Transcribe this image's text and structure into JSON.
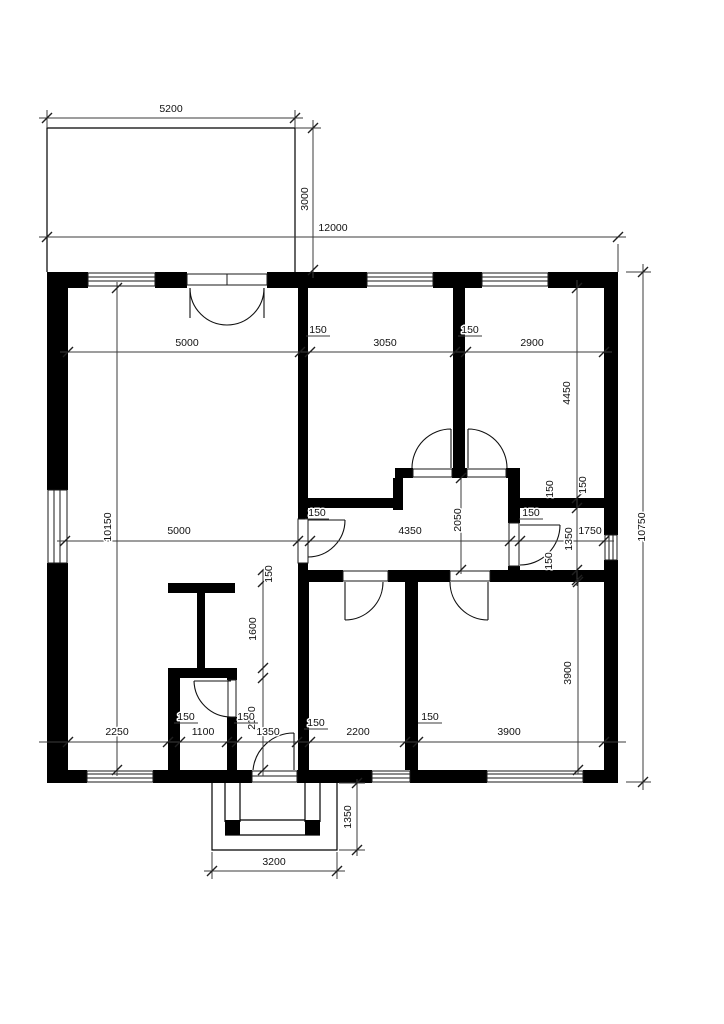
{
  "figure": {
    "kind": "architectural floor plan",
    "units": "mm"
  },
  "colors": {
    "wall": "#000000",
    "line": "#3b3b3b",
    "background": "#ffffff",
    "text": "#111111"
  },
  "dim_labels": [
    {
      "name": "terrace-width",
      "t": "5200",
      "x": 171,
      "y": 112,
      "r": 0,
      "ul": false
    },
    {
      "name": "overall-width",
      "t": "12000",
      "x": 333,
      "y": 231,
      "r": 0,
      "ul": false
    },
    {
      "name": "terrace-depth",
      "t": "3000",
      "x": 308,
      "y": 199,
      "r": -90,
      "ul": false
    },
    {
      "name": "overall-depth",
      "t": "10750",
      "x": 645,
      "y": 527,
      "r": -90,
      "ul": false
    },
    {
      "name": "interior-depth",
      "t": "10150",
      "x": 111,
      "y": 527,
      "r": -90,
      "ul": false
    },
    {
      "name": "living-width-top",
      "t": "5000",
      "x": 187,
      "y": 346,
      "r": 0,
      "ul": false
    },
    {
      "name": "room2-width",
      "t": "3050",
      "x": 385,
      "y": 346,
      "r": 0,
      "ul": false
    },
    {
      "name": "room3-width",
      "t": "2900",
      "x": 532,
      "y": 346,
      "r": 0,
      "ul": false
    },
    {
      "name": "wall-150-top-1",
      "t": "150",
      "x": 318,
      "y": 333,
      "r": 0,
      "ul": true
    },
    {
      "name": "wall-150-top-2",
      "t": "150",
      "x": 470,
      "y": 333,
      "r": 0,
      "ul": true
    },
    {
      "name": "room3-depth",
      "t": "4450",
      "x": 570,
      "y": 393,
      "r": -90,
      "ul": false
    },
    {
      "name": "living-width-mid",
      "t": "5000",
      "x": 179,
      "y": 534,
      "r": 0,
      "ul": false
    },
    {
      "name": "hall-width",
      "t": "4350",
      "x": 410,
      "y": 534,
      "r": 0,
      "ul": false
    },
    {
      "name": "bath-width",
      "t": "1750",
      "x": 590,
      "y": 534,
      "r": 0,
      "ul": false
    },
    {
      "name": "wall-150-hall-door",
      "t": "150",
      "x": 317,
      "y": 516,
      "r": 0,
      "ul": true
    },
    {
      "name": "wall-150-bath-door",
      "t": "150",
      "x": 531,
      "y": 516,
      "r": 0,
      "ul": true
    },
    {
      "name": "wall-150-bath-top-a",
      "t": "150",
      "x": 553,
      "y": 489,
      "r": -90,
      "ul": false
    },
    {
      "name": "wall-150-bath-top-b",
      "t": "150",
      "x": 586,
      "y": 485,
      "r": -90,
      "ul": false
    },
    {
      "name": "bath-depth",
      "t": "1350",
      "x": 572,
      "y": 539,
      "r": -90,
      "ul": false
    },
    {
      "name": "wall-150-bath-bottom",
      "t": "150",
      "x": 552,
      "y": 561,
      "r": -90,
      "ul": false
    },
    {
      "name": "hall-depth",
      "t": "2050",
      "x": 461,
      "y": 520,
      "r": -90,
      "ul": false
    },
    {
      "name": "wall-150-hall-bottom",
      "t": "150",
      "x": 272,
      "y": 574,
      "r": -90,
      "ul": false
    },
    {
      "name": "closet-depth",
      "t": "1600",
      "x": 256,
      "y": 629,
      "r": -90,
      "ul": false
    },
    {
      "name": "lobby-depth",
      "t": "2150",
      "x": 255,
      "y": 718,
      "r": -90,
      "ul": false
    },
    {
      "name": "room5-depth",
      "t": "3900",
      "x": 571,
      "y": 673,
      "r": -90,
      "ul": false
    },
    {
      "name": "living-width-bottom",
      "t": "2250",
      "x": 117,
      "y": 735,
      "r": 0,
      "ul": false
    },
    {
      "name": "wall-150-wc-left",
      "t": "150",
      "x": 186,
      "y": 720,
      "r": 0,
      "ul": true
    },
    {
      "name": "wc-width",
      "t": "1100",
      "x": 203,
      "y": 735,
      "r": 0,
      "ul": false
    },
    {
      "name": "wall-150-wc-right",
      "t": "150",
      "x": 246,
      "y": 720,
      "r": 0,
      "ul": true
    },
    {
      "name": "lobby-width",
      "t": "1350",
      "x": 268,
      "y": 735,
      "r": 0,
      "ul": false
    },
    {
      "name": "wall-150-lobby-right",
      "t": "150",
      "x": 316,
      "y": 726,
      "r": 0,
      "ul": true
    },
    {
      "name": "room4-width",
      "t": "2200",
      "x": 358,
      "y": 735,
      "r": 0,
      "ul": false
    },
    {
      "name": "wall-150-rooms45",
      "t": "150",
      "x": 430,
      "y": 720,
      "r": 0,
      "ul": true
    },
    {
      "name": "room5-width",
      "t": "3900",
      "x": 509,
      "y": 735,
      "r": 0,
      "ul": false
    },
    {
      "name": "porch-depth",
      "t": "1350",
      "x": 351,
      "y": 817,
      "r": -90,
      "ul": false
    },
    {
      "name": "porch-width",
      "t": "3200",
      "x": 274,
      "y": 865,
      "r": 0,
      "ul": false
    }
  ]
}
